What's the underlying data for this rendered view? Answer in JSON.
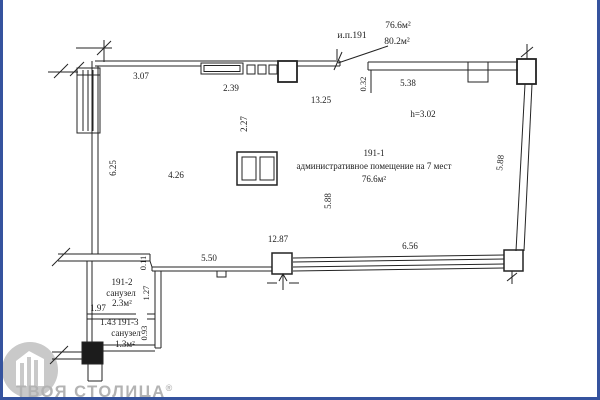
{
  "colors": {
    "border": "#35539e",
    "line": "#232323",
    "watermark_text": "#b3b3b3",
    "logo_circle": "#c9c9c9"
  },
  "header": {
    "unit_label": "и.п.191",
    "area_top": "76.6м²",
    "area_bottom": "80.2м²"
  },
  "rooms": {
    "main": {
      "number": "191-1",
      "name": "административное помещение на 7 мест",
      "area": "76.6м²",
      "ceiling_height": "h=3.02"
    },
    "wc1": {
      "number": "191-2",
      "name": "санузел",
      "area": "2.3м²"
    },
    "wc2": {
      "number": "191-3",
      "name": "санузел",
      "area": "1.3м²"
    }
  },
  "dims": {
    "top_left": "3.07",
    "window_top": "2.39",
    "top_span": "13.25",
    "right_offset": "0.32",
    "top_right": "5.38",
    "inner_width": "4.26",
    "inner_offset": "2.27",
    "left_height": "6.25",
    "inner_height": "5.88",
    "right_height": "5.88",
    "bottom_span": "12.87",
    "bottom_left": "5.50",
    "bottom_right": "6.56",
    "jog": "0.11",
    "wc1_height": "1.27",
    "wc1_width": "1.97",
    "wc2_height": "0.93",
    "wc2_width": "1.43"
  },
  "watermark": {
    "brand": "ТВОЯ СТОЛИЦА",
    "reg": "®"
  }
}
